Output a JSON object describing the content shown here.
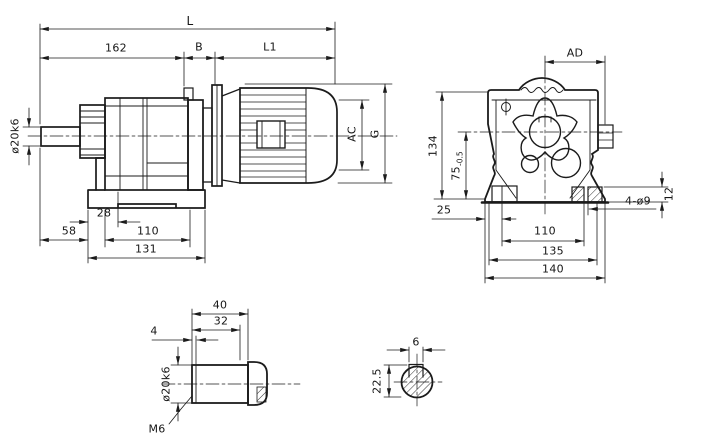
{
  "colors": {
    "ink": "#1b1b1b",
    "background": "#ffffff"
  },
  "side_view": {
    "dims": {
      "total_length": "L",
      "gear_unit_length": "162",
      "b_section": "B",
      "motor_length": "L1",
      "shaft_diameter": "ø20k6",
      "motor_diameter": "AC",
      "overall_height": "G",
      "foot_offset": "28",
      "shaft_length": "58",
      "foot_hole_spacing": "110",
      "foot_length": "131"
    }
  },
  "front_view": {
    "dims": {
      "terminal_box_width": "AD",
      "overall_height": "134",
      "shaft_center_height": "75",
      "shaft_center_tolerance": "-0.5",
      "foot_edge_offset": "25",
      "hole_spacing": "110",
      "foot_width": "135",
      "base_width": "140",
      "mounting_holes": "4-ø9",
      "foot_thickness": "12"
    }
  },
  "shaft_detail": {
    "dims": {
      "shaft_length": "40",
      "usable_length": "32",
      "chamfer": "4",
      "diameter": "ø20k6",
      "center_thread": "M6"
    }
  },
  "key_section": {
    "dims": {
      "key_width": "6",
      "bore_height": "22.5"
    }
  }
}
